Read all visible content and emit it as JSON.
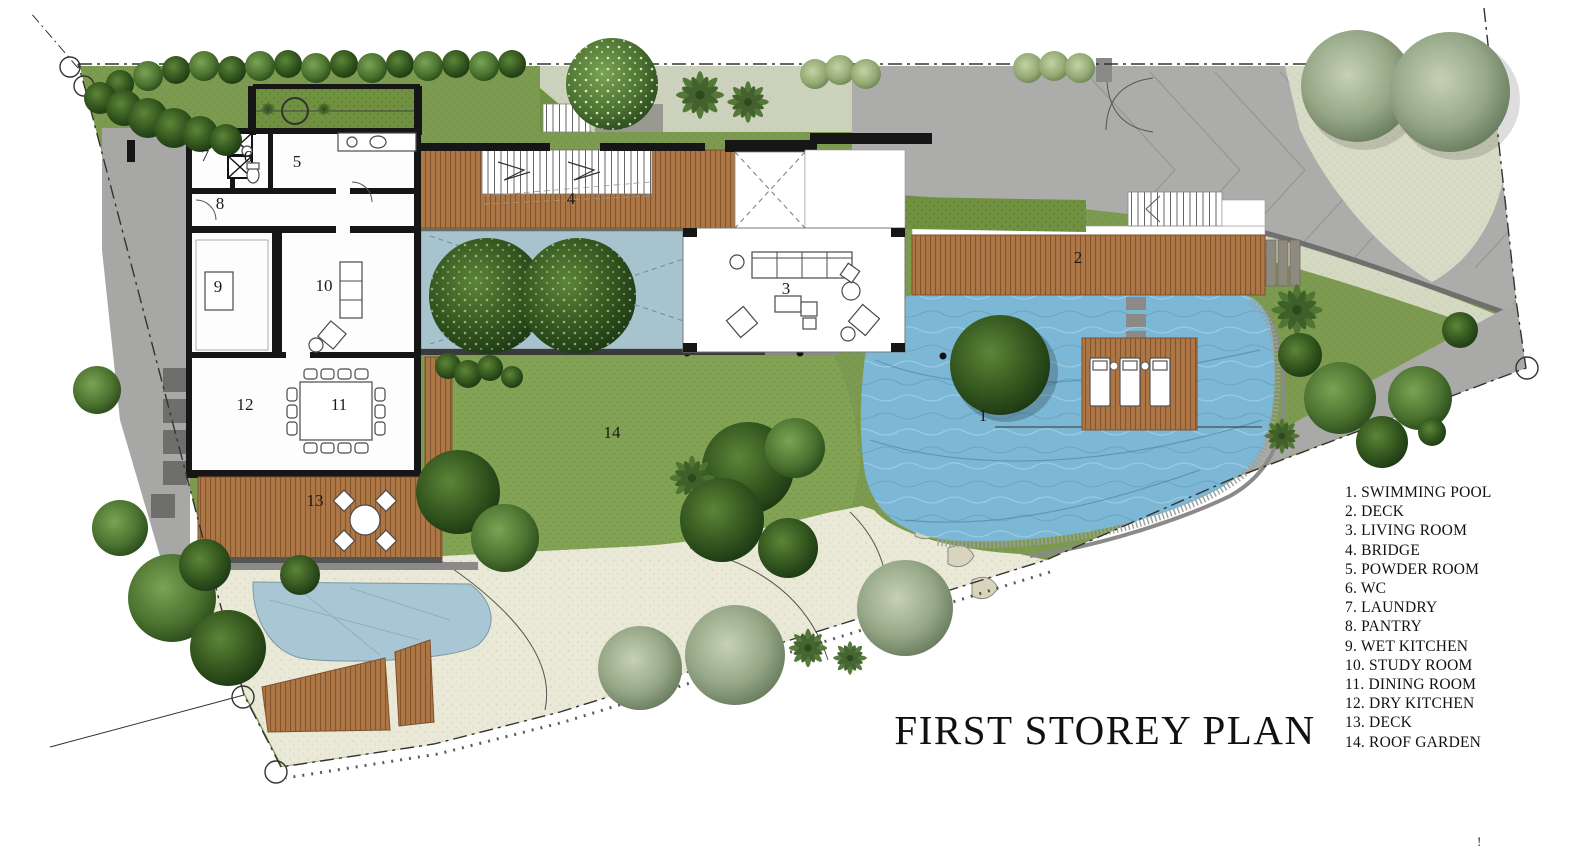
{
  "title": {
    "text": "FIRST STOREY PLAN"
  },
  "legend": {
    "items": [
      "1. SWIMMING POOL",
      "2. DECK",
      "3. LIVING ROOM",
      "4. BRIDGE",
      "5. POWDER ROOM",
      "6. WC",
      "7. LAUNDRY",
      "8. PANTRY",
      "9. WET KITCHEN",
      "10. STUDY ROOM",
      "11. DINING ROOM",
      "12. DRY KITCHEN",
      "13. DECK",
      "14. ROOF GARDEN"
    ]
  },
  "plan": {
    "labels": [
      {
        "n": "1",
        "x": 983,
        "y": 421
      },
      {
        "n": "2",
        "x": 1078,
        "y": 263
      },
      {
        "n": "3",
        "x": 786,
        "y": 294
      },
      {
        "n": "4",
        "x": 571,
        "y": 204
      },
      {
        "n": "5",
        "x": 297,
        "y": 167
      },
      {
        "n": "6",
        "x": 248,
        "y": 162
      },
      {
        "n": "7",
        "x": 205,
        "y": 161
      },
      {
        "n": "8",
        "x": 220,
        "y": 209
      },
      {
        "n": "9",
        "x": 218,
        "y": 292
      },
      {
        "n": "10",
        "x": 324,
        "y": 291
      },
      {
        "n": "11",
        "x": 339,
        "y": 410
      },
      {
        "n": "12",
        "x": 245,
        "y": 410
      },
      {
        "n": "13",
        "x": 315,
        "y": 506
      },
      {
        "n": "14",
        "x": 612,
        "y": 438
      }
    ]
  },
  "colors": {
    "lawn": "#7d9b50",
    "roof_garden": "#82a254",
    "deck_wood": "#ad7645",
    "pool": "#7cb8d6",
    "driveway": "#acacaa",
    "sand_path": "#eae8d6",
    "entry_court": "#ccd2bb",
    "pond": "#a7c3cd",
    "wall": "#161616"
  },
  "stray_mark": "!"
}
